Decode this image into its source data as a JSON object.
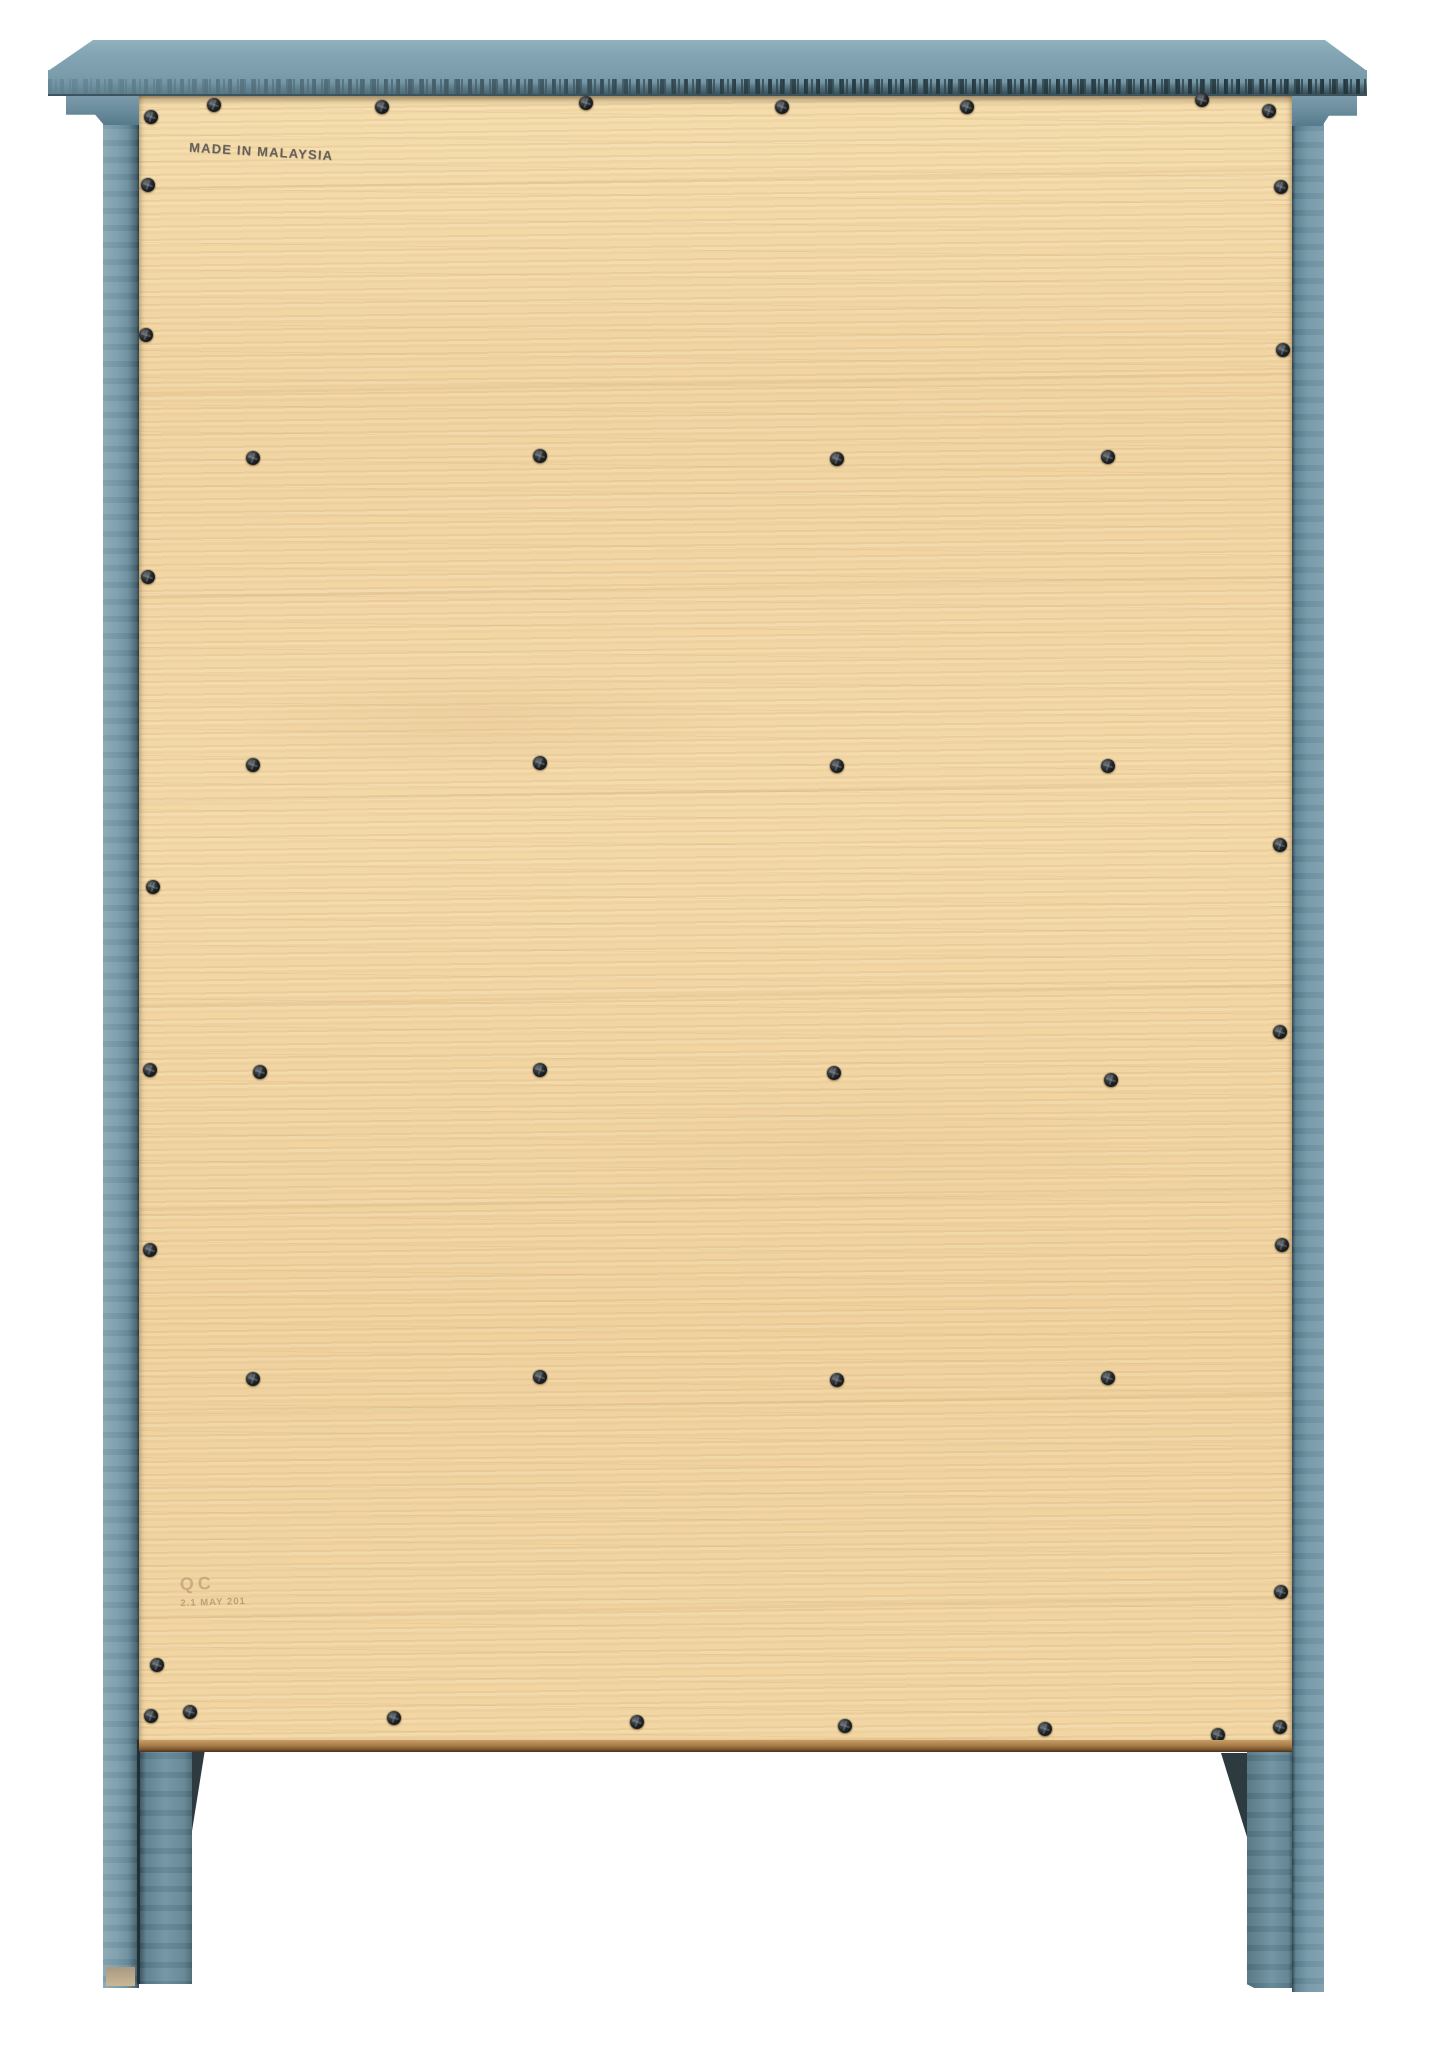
{
  "stamps": {
    "made_in": "MADE IN MALAYSIA",
    "qc_mark": "QC",
    "qc_date": "2.1 MAY 201"
  },
  "colors": {
    "background": "#ffffff",
    "top_paint": "#7d9fae",
    "frame_paint": "#6d8fa0",
    "frame_shadow": "#31474f",
    "distress_band": "#3c545e",
    "panel_wood_light": "#f4dcab",
    "panel_wood_mid": "#f0d3a0",
    "panel_plywood_edge": "#9a6f42",
    "screw_head": "#1c2124",
    "bracket": "#2d3b40"
  },
  "screws": [
    [
      151,
      117
    ],
    [
      214,
      105
    ],
    [
      382,
      107
    ],
    [
      586,
      103
    ],
    [
      782,
      107
    ],
    [
      967,
      107
    ],
    [
      1202,
      100
    ],
    [
      1269,
      111
    ],
    [
      148,
      185
    ],
    [
      146,
      335
    ],
    [
      148,
      577
    ],
    [
      153,
      887
    ],
    [
      150,
      1070
    ],
    [
      150,
      1250
    ],
    [
      157,
      1665
    ],
    [
      1281,
      187
    ],
    [
      1283,
      350
    ],
    [
      1280,
      845
    ],
    [
      1280,
      1032
    ],
    [
      1282,
      1245
    ],
    [
      1281,
      1592
    ],
    [
      253,
      458
    ],
    [
      540,
      456
    ],
    [
      837,
      459
    ],
    [
      1108,
      457
    ],
    [
      253,
      765
    ],
    [
      540,
      763
    ],
    [
      837,
      766
    ],
    [
      1108,
      766
    ],
    [
      260,
      1072
    ],
    [
      540,
      1070
    ],
    [
      834,
      1073
    ],
    [
      1111,
      1080
    ],
    [
      253,
      1379
    ],
    [
      540,
      1377
    ],
    [
      837,
      1380
    ],
    [
      1108,
      1378
    ],
    [
      151,
      1716
    ],
    [
      190,
      1712
    ],
    [
      394,
      1718
    ],
    [
      637,
      1722
    ],
    [
      845,
      1726
    ],
    [
      1045,
      1729
    ],
    [
      1218,
      1735
    ],
    [
      1280,
      1727
    ]
  ]
}
